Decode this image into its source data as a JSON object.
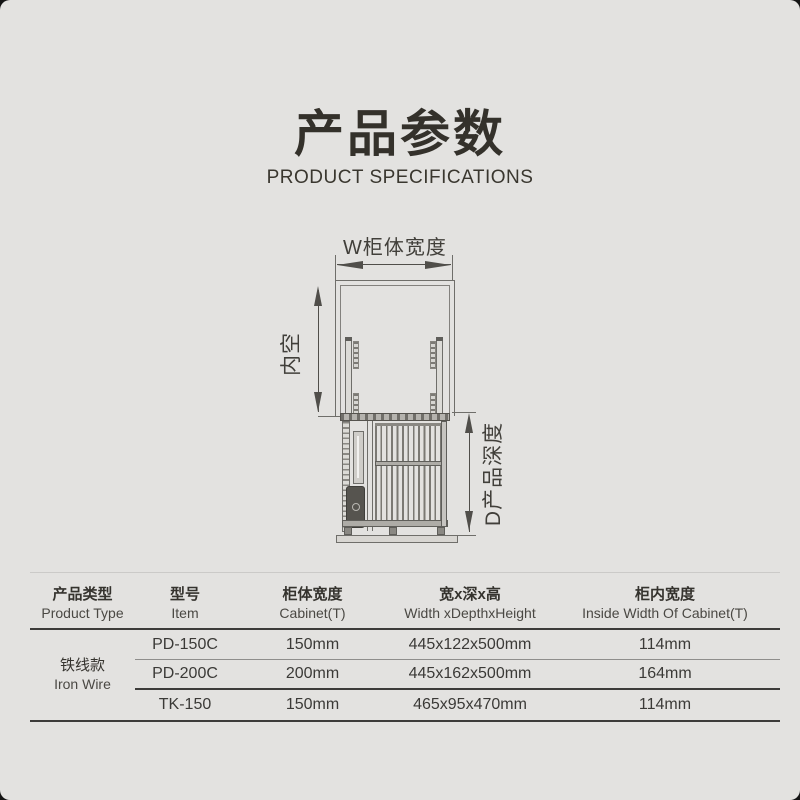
{
  "header": {
    "title": "产品参数",
    "subtitle": "PRODUCT SPECIFICATIONS"
  },
  "diagram": {
    "width_label": "W柜体宽度",
    "inner_label": "内空",
    "depth_label": "D产品深度"
  },
  "table": {
    "headers": [
      {
        "zh": "产品类型",
        "en": "Product Type"
      },
      {
        "zh": "型号",
        "en": "Item"
      },
      {
        "zh": "柜体宽度",
        "en": "Cabinet(T)"
      },
      {
        "zh": "宽x深x高",
        "en": "Width xDepthxHeight"
      },
      {
        "zh": "柜内宽度",
        "en": "Inside Width Of Cabinet(T)"
      }
    ],
    "category": {
      "zh": "铁线款",
      "en": "Iron Wire"
    },
    "rows": [
      {
        "item": "PD-150C",
        "cabinet": "150mm",
        "wdh": "445x122x500mm",
        "inside": "114mm"
      },
      {
        "item": "PD-200C",
        "cabinet": "200mm",
        "wdh": "445x162x500mm",
        "inside": "164mm"
      },
      {
        "item": "TK-150",
        "cabinet": "150mm",
        "wdh": "465x95x470mm",
        "inside": "114mm"
      }
    ]
  },
  "colors": {
    "background": "#e3e2e0",
    "text_dark": "#34312b",
    "table_rule_dark": "#3d3c3a",
    "table_rule_light": "#8f8e8c",
    "diagram_line": "#6f6e6a"
  }
}
